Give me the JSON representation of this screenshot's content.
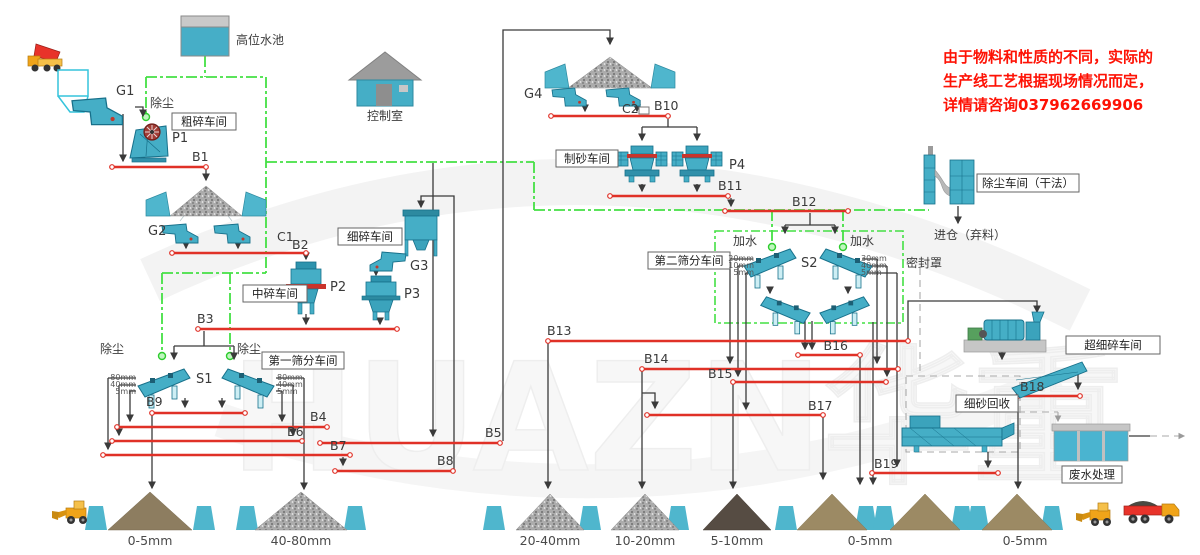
{
  "notice": {
    "line1": "由于物料和性质的不同，实际的",
    "line2": "生产线工艺根据现场情况而定，",
    "line3": "详情请咨询037962669906"
  },
  "watermark": "HUAZN华重",
  "facilities": {
    "water_tank": "高位水池",
    "control_room": "控制室",
    "coarse_ws": "粗碎车间",
    "medium_ws": "中碎车间",
    "fine_ws": "细碎车间",
    "screen1_ws": "第一筛分车间",
    "sand_ws": "制砂车间",
    "screen2_ws": "第二筛分车间",
    "dust_ws": "除尘车间（干法）",
    "ultrafine_ws": "超细碎车间",
    "sand_recovery": "细砂回收",
    "wastewater": "废水处理"
  },
  "annotations": {
    "dust_p1": "除尘",
    "dust_s1_left": "除尘",
    "dust_s1_right": "除尘",
    "add_water_left": "加水",
    "add_water_right": "加水",
    "sealed_cover": "密封罩",
    "silo_waste": "进仓（弃料）"
  },
  "equipment": {
    "g1": "G1",
    "g2": "G2",
    "g3": "G3",
    "g4": "G4",
    "p1": "P1",
    "p2": "P2",
    "p3": "P3",
    "p4": "P4",
    "s1": "S1",
    "s2": "S2",
    "c1": "C1",
    "c2": "C2"
  },
  "conveyors": {
    "b1": "B1",
    "b2": "B2",
    "b3": "B3",
    "b4": "B4",
    "b5": "B5",
    "b6": "B6",
    "b7": "B7",
    "b8": "B8",
    "b9": "B9",
    "b10": "B10",
    "b11": "B11",
    "b12": "B12",
    "b13": "B13",
    "b14": "B14",
    "b15": "B15",
    "b16": "B16",
    "b17": "B17",
    "b18": "B18",
    "b19": "B19"
  },
  "screen_sizes": {
    "s1_left": [
      "80mm",
      "40mm",
      "5mm"
    ],
    "s1_right": [
      "80mm",
      "40mm",
      "5mm"
    ],
    "s2_left": [
      "20mm",
      "10mm",
      "5mm"
    ],
    "s2_right": [
      "30mm",
      "40mm",
      "5mm"
    ]
  },
  "stockpiles": [
    {
      "label": "0-5mm"
    },
    {
      "label": "40-80mm"
    },
    {
      "label": "20-40mm"
    },
    {
      "label": "10-20mm"
    },
    {
      "label": "5-10mm"
    },
    {
      "label": "0-5mm"
    },
    {
      "label": "0-5mm"
    }
  ],
  "colors": {
    "machine": "#45aec6",
    "conveyor_line": "#e03127",
    "water_line": "#44e044",
    "notice_text": "#fe1205",
    "cyan_block": "#4fb6cd"
  }
}
